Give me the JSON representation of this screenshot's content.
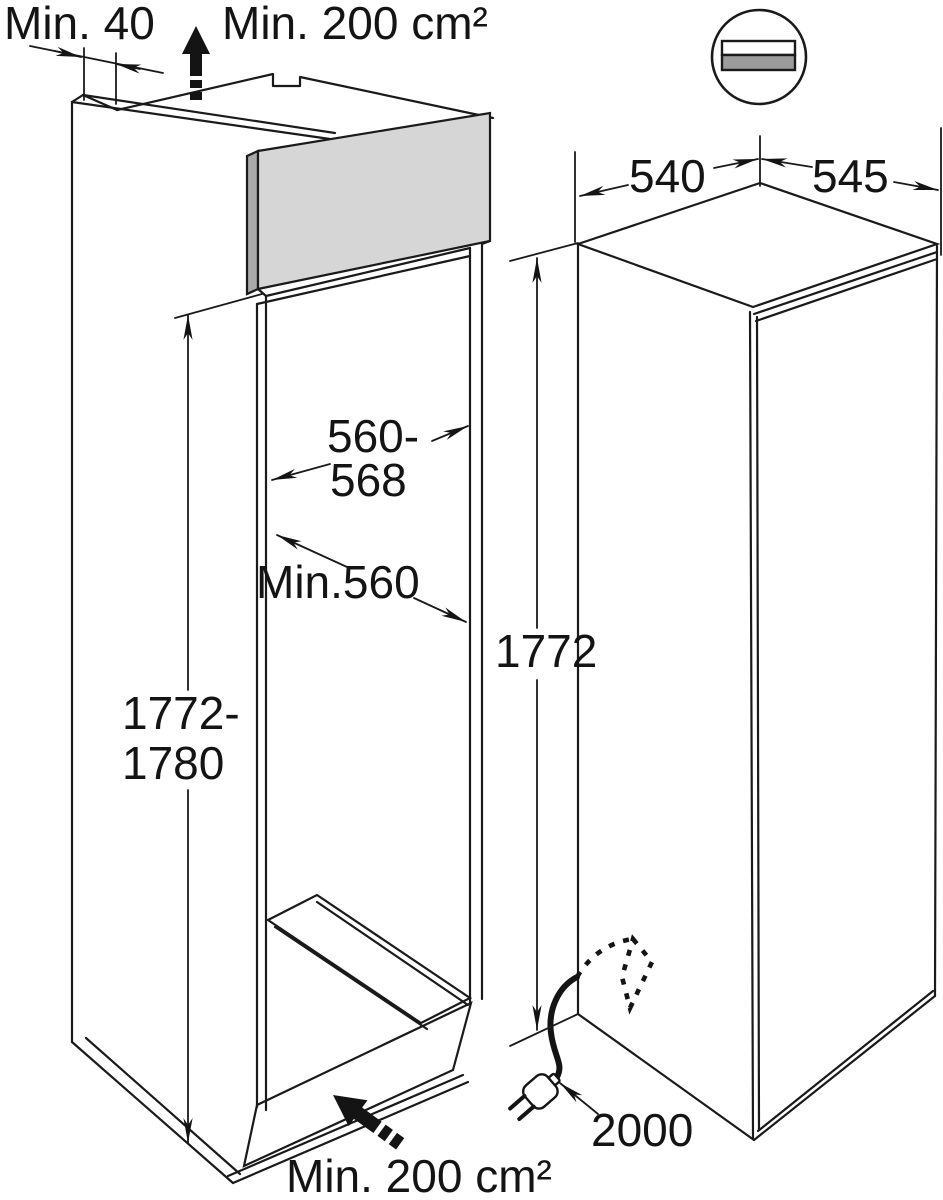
{
  "figure": {
    "type": "appliance-installation-diagram",
    "background": "#ffffff",
    "line_color": "#1a1a1a",
    "niche": {
      "rear_gap": "Min. 40",
      "top_vent_area": "Min. 200 cm²",
      "width_line1": "560-",
      "width_line2": "568",
      "depth": "Min.560",
      "height_line1": "1772-",
      "height_line2": "1780",
      "bottom_vent_area": "Min. 200 cm²",
      "panel_front_color": "#d6d6d6",
      "panel_edge_color": "#a9a9a9"
    },
    "appliance": {
      "dim_left": "540",
      "dim_right": "545",
      "height": "1772",
      "cord_length": "2000"
    },
    "vent_icon": {
      "name": "worktop-vent-cross-section-icon",
      "top_bar_fill": "#ffffff",
      "bottom_bar_fill": "#9c9c9c"
    }
  }
}
